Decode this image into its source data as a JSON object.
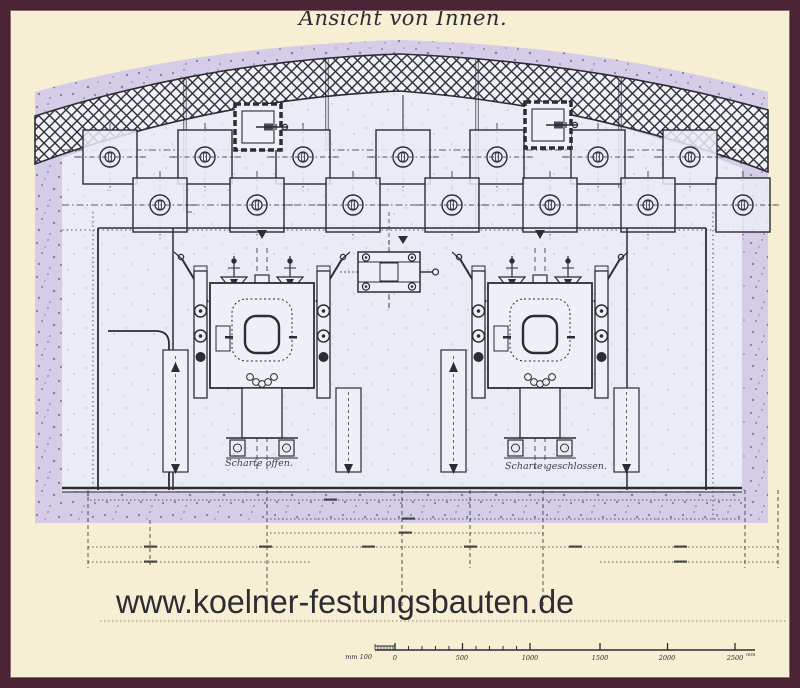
{
  "frame": {
    "color": "#4a2434"
  },
  "page": {
    "background": "#f6efd3"
  },
  "title": {
    "text": "Ansicht von Innen.",
    "ink": "#2f3453"
  },
  "drawing": {
    "paper_color": "#e9ecf4",
    "earth_color": "#d5cce8",
    "ink_color": "#2c2c34",
    "label_embrasure_open": "Scharte offen.",
    "label_embrasure_closed": "Scharte geschlossen."
  },
  "watermark": {
    "text": "www.koelner-festungsbauten.de",
    "color": "#b01010"
  },
  "scalebar": {
    "unit_prefix": "mm 100",
    "labels": [
      "0",
      "500",
      "1000",
      "1500",
      "2000",
      "2500"
    ],
    "unit_suffix": "mm"
  }
}
